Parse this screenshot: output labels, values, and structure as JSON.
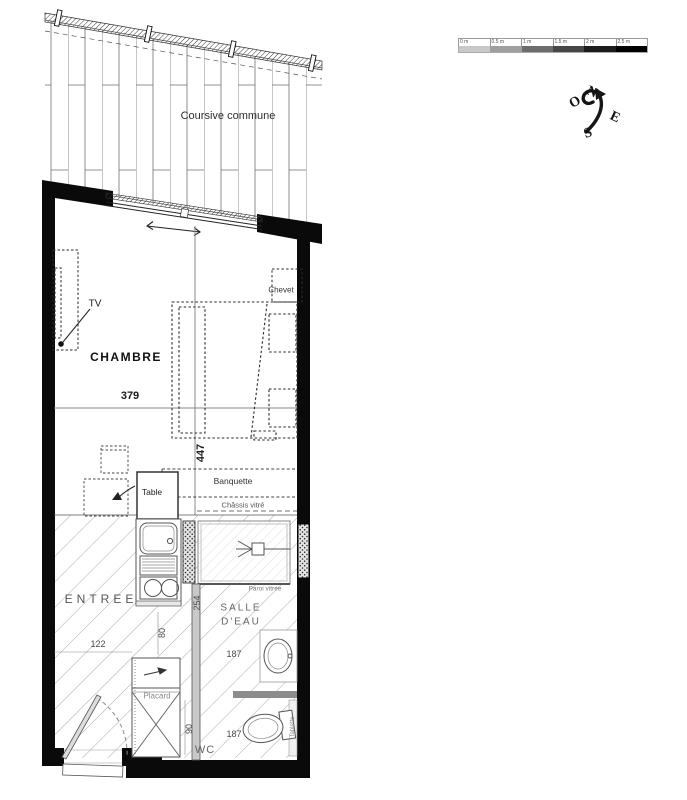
{
  "plan": {
    "coursive_label": "Coursive commune",
    "rooms": {
      "chambre": "CHAMBRE",
      "entree": "ENTREE",
      "salle_deau_line1": "SALLE",
      "salle_deau_line2": "D'EAU",
      "wc": "WC"
    },
    "furniture": {
      "tv": "TV",
      "chevet": "Chevet",
      "banquette": "Banquette",
      "table": "Table",
      "placard": "Placard",
      "tablette": "Tablette"
    },
    "glazing": {
      "chassis_vitre": "Châssis vitré",
      "paroi_vitree": "Paroi vitrée"
    },
    "dimensions": {
      "chambre_width": "379",
      "chambre_depth": "447",
      "entree_width": "122",
      "bathroom_width": "187",
      "bathroom_depth": "254",
      "kitchen_clearance": "80",
      "wc_width": "90",
      "wc_length": "187"
    }
  },
  "scale_bar": {
    "labels": [
      "0 m",
      "0.5 m",
      "1 m",
      "1.5 m",
      "2 m",
      "2.5 m"
    ],
    "segment_styles": [
      "background:#c8c8c8",
      "background:#9f9f9f",
      "background:#6d6d6d",
      "background:#474747",
      "background:#1c1c1c",
      "background:#000000"
    ]
  },
  "compass": {
    "north": "N",
    "east": "E",
    "south": "S",
    "west": "O"
  }
}
